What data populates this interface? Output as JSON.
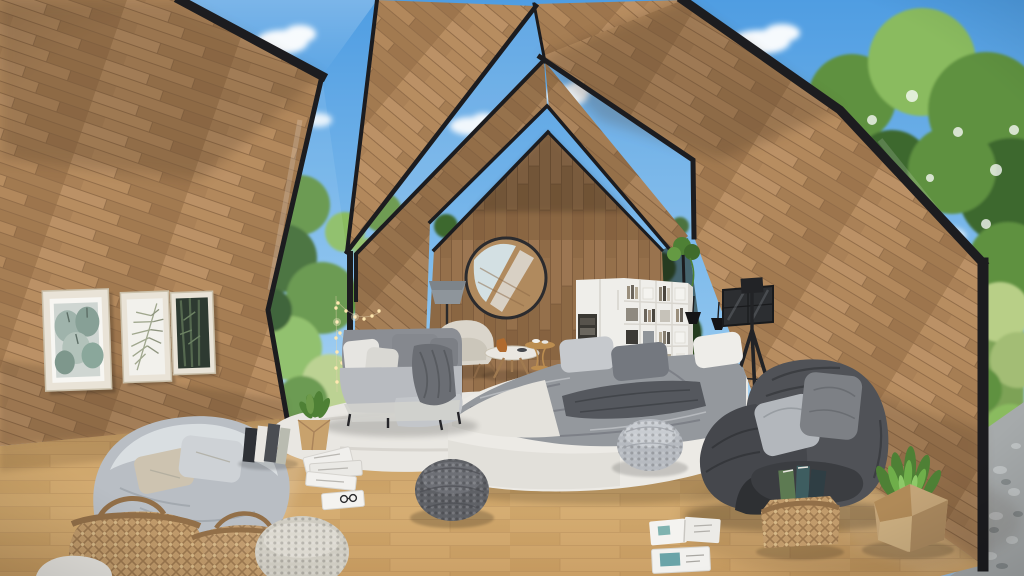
{
  "scene": {
    "description": "Sunlit A-frame attic interior with nested wooden gables, chevron skylights showing blue sky and trees, and cozy gray lounge furniture",
    "objects": [
      "chevron-skylights",
      "glass-gable-windows",
      "wood-plank-walls",
      "oak-floor",
      "gallery-wall-prints",
      "round-mirror",
      "gray-floor-lamp",
      "cream-armchair",
      "round-coffee-tables",
      "gray-sectional-sofa",
      "string-lights",
      "white-wardrobe-bookshelf",
      "pendant-lamps",
      "smoked-glass-cabinet",
      "black-tripod-lamp",
      "bed-with-gray-bedding",
      "white-fur-rug",
      "knitted-poufs",
      "bean-bag-chair",
      "wicker-baskets",
      "book-stack",
      "potted-plants",
      "magazines",
      "charcoal-lounge-chair",
      "book-basket",
      "faceted-planter",
      "garden-view",
      "pebble-patio"
    ]
  },
  "palette": {
    "sky_top": "#4f9de2",
    "sky_low": "#bfe0f7",
    "cloud": "#ffffff",
    "foliage_dark": "#3d672f",
    "foliage_mid": "#5f9140",
    "foliage_light": "#8abb5e",
    "foliage_pale": "#b8cf87",
    "trunk": "#6f5843",
    "wood_light": "#c29a6a",
    "wood_mid": "#aa8157",
    "wood_dark": "#8c6947",
    "wood_back": "#86684a",
    "plank_line": "#7a5a3b",
    "frame_dark": "#1c1c1f",
    "floor_light": "#d7b076",
    "floor_mid": "#c69d65",
    "floor_line": "#a67e4e",
    "white_soft": "#efeeea",
    "gray_light": "#c3c6ca",
    "gray_mid": "#94989d",
    "gray_dark": "#5b5e63",
    "charcoal": "#45474c",
    "beige": "#cdc3b0",
    "wicker": "#c19b6b",
    "wicker_dark": "#926f48",
    "rug": "#e9e7e2",
    "pebble": "#a6aaab",
    "green_plant": "#4e8035",
    "book_teal": "#3e5d60",
    "book_green": "#5d7a52",
    "brass": "#bb8d50",
    "lamp_gray": "#8e959b"
  }
}
